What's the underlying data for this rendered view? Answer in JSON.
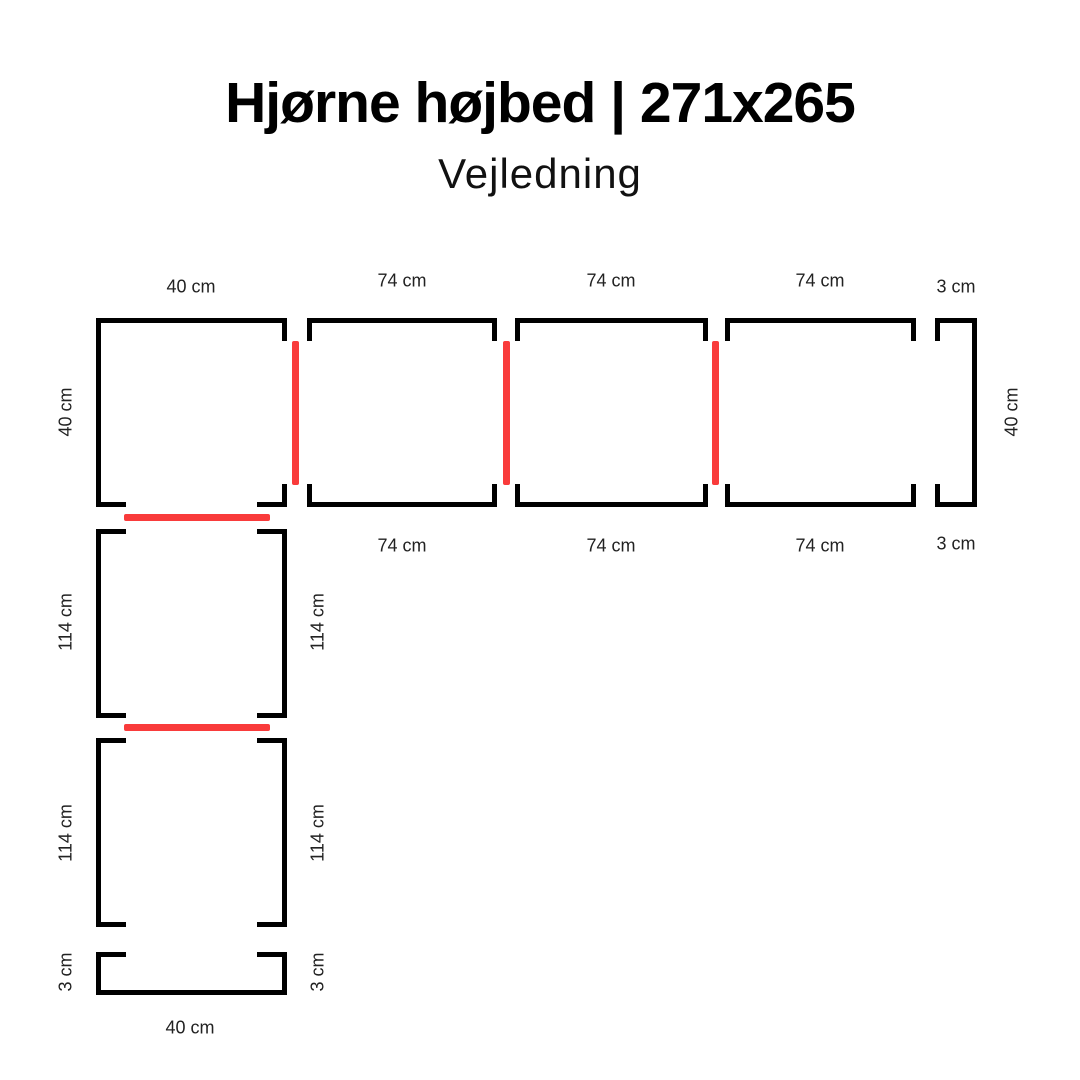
{
  "header": {
    "title": "Hjørne højbed | 271x265",
    "subtitle": "Vejledning"
  },
  "colors": {
    "outline": "#000000",
    "connector": "#f93b3b",
    "label": "#222222",
    "background": "#ffffff"
  },
  "diagram": {
    "top_row": {
      "corner_panel": {
        "top_label": "40 cm",
        "side_label": "40 cm"
      },
      "board_1": {
        "top_label": "74 cm",
        "bottom_label": "74 cm"
      },
      "board_2": {
        "top_label": "74 cm",
        "bottom_label": "74 cm"
      },
      "board_3": {
        "top_label": "74 cm",
        "bottom_label": "74 cm"
      },
      "end_strip": {
        "top_label": "3 cm",
        "bottom_label": "3 cm",
        "side_label": "40 cm"
      }
    },
    "left_column": {
      "board_1": {
        "left_label": "114 cm",
        "right_label": "114 cm"
      },
      "board_2": {
        "left_label": "114 cm",
        "right_label": "114 cm"
      },
      "end_strip": {
        "left_label": "3 cm",
        "right_label": "3 cm",
        "bottom_label": "40 cm"
      }
    }
  }
}
